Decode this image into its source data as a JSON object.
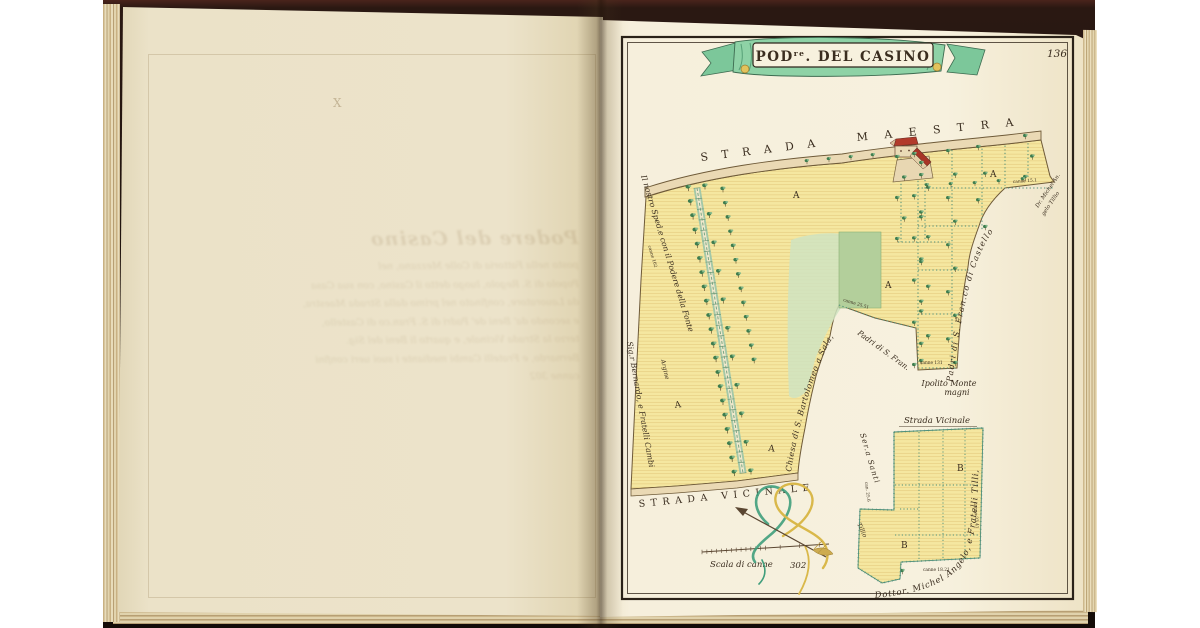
{
  "page": {
    "number": "136"
  },
  "banner": {
    "prefix": "POD",
    "sup": "re",
    "suffix": ". DEL CASINO"
  },
  "roads": {
    "maestra_1": "STRADA",
    "maestra_2": "MAESTRA",
    "vicinale": "STRADA VICINALE",
    "vicinale_small": "Strada Vicinale"
  },
  "labels": {
    "west_neighbor": "Il nostro Sped.e con il Podere della Fonte",
    "argine": "Argine",
    "southwest_neighbor": "Sig.r Bernardo, e Fratelli Cambi",
    "church": "Chiesa di S. Bartolomeo a Sala,",
    "padri_fran": "Padri di S. Fran.",
    "ipolito_1": "Ipolito Monte",
    "ipolito_2": "magni",
    "castello": "Padri di S. Fran.co  di  Castello",
    "tilli_ne_1": "Dr. Michel'An.",
    "tilli_ne_2": "gelo Tillio",
    "santi": "Ser.a Santi",
    "inset_owner": "Dottor. Michel Angelo, e Fratelli Tilli,",
    "inset_edge": "Tillio"
  },
  "letters": {
    "a": "A",
    "b": "B"
  },
  "scale": {
    "caption": "Scala di canne",
    "value": "302"
  },
  "measurements": [
    "canne 102",
    "canne 25.51",
    "canne 131",
    "canne 15.1",
    "can. 25.6",
    "canne 18.21",
    "canne 33.41"
  ],
  "ghost": {
    "mark": "X",
    "heading": "Podere del Casino",
    "lines": [
      "posto nella Fattoria di Colle Mezzano, nel",
      "Popolo di S. Regolo, luogo detto il Casino, con sua Casa",
      "da Lauoratore, confinato nel primo dalla Strada Maestra,",
      "e secondo da' Beni de' Padri di S. Fran.co di Castello,",
      "terzo la Strada Vicinale, e quarto li Beni del Sig.",
      "Bernardo, e Fratelli Cambi mediante i suoi ueri confini",
      "canne 302"
    ]
  },
  "icons": {
    "tree-icon": "small green tree symbol",
    "north-arrow-icon": "arrow through ribbon knot",
    "ribbon-banner-icon": "green title ribbon",
    "building-icon": "red-roofed farmhouse"
  },
  "colors": {
    "field_yellow": "#f5e7a0",
    "hatch": "#ddc172",
    "tree_green": "#3d7c4e",
    "banner_green": "#8ed2a6",
    "roof_red": "#b23b2b",
    "ink": "#3a2d1f",
    "road_tan": "#ead9b4",
    "dotted_teal": "#4e8f7a",
    "page_cream": "#f6efdc",
    "cover_dark": "#2a1812"
  }
}
